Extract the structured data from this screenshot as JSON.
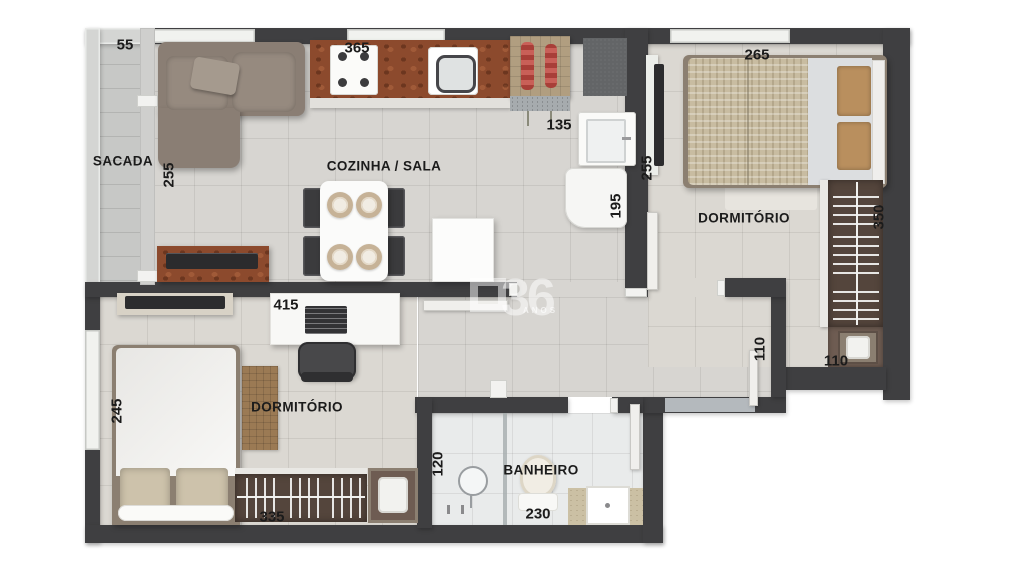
{
  "plan_title": "apartment-floor-plan",
  "rooms": {
    "sacada": {
      "label": "SACADA"
    },
    "cozinha_sala": {
      "label": "COZINHA / SALA"
    },
    "dormitorio1": {
      "label": "DORMITÓRIO"
    },
    "dormitorio2": {
      "label": "DORMITÓRIO"
    },
    "banheiro": {
      "label": "BANHEIRO"
    }
  },
  "dimensions": {
    "sacada_width": "55",
    "kitchen_run": "365",
    "service_width": "135",
    "service_depth": "195",
    "sala_side": "255",
    "dorm1_side": "255",
    "dorm1_width": "265",
    "closet_run": "350",
    "closet_nook": "110",
    "entry_door": "110",
    "desk_wall": "415",
    "dorm2_depth": "245",
    "wardrobe_run": "335",
    "shower_width": "120",
    "banheiro_width": "230"
  },
  "watermark": {
    "number": "36",
    "caption": "ANOS"
  },
  "furniture": [
    "sofa",
    "chaise-pillow",
    "tv-rack",
    "tv",
    "dining-table",
    "plates",
    "chairs",
    "refrigerator",
    "kitchen-counter",
    "stove",
    "sink",
    "barbecue-grill",
    "service-mat",
    "laundry-tank",
    "washing-machine",
    "double-bed",
    "cushions",
    "closet-hangers",
    "hamper",
    "desk",
    "laptop",
    "office-chair",
    "rug",
    "wardrobe-hangers",
    "mirror-box",
    "shower",
    "glass-partition",
    "toilet",
    "vanity-sink",
    "door-leaves",
    "entry-threshold"
  ],
  "colors": {
    "wall": "#3f3f41",
    "floor_living": "#d7d5d1",
    "floor_bedroom": "#dbd8d2",
    "floor_bath": "#e9ebeb",
    "floor_balcony": "#c7c8c6",
    "counter_granite": "#8c4a2d",
    "wardrobe_wood": "#54453c",
    "duvet_beige": "#c8bca1",
    "grill_red": "#bf5a52"
  }
}
